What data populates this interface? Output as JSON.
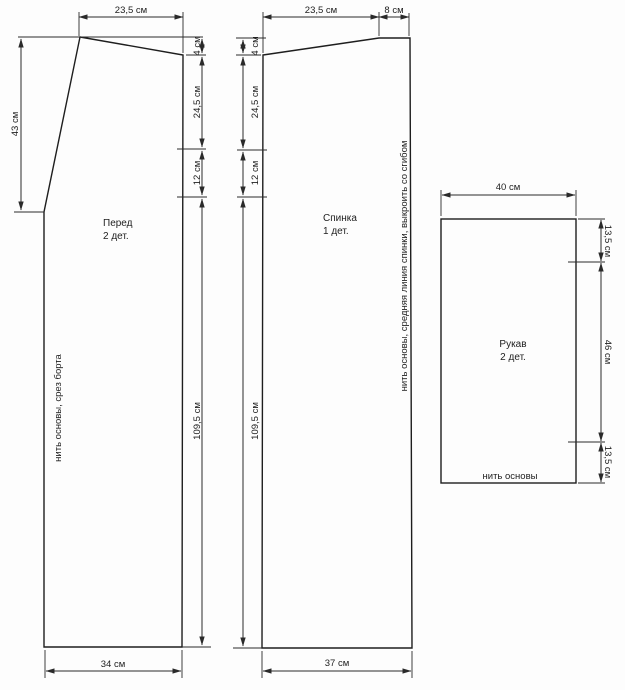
{
  "pieces": {
    "front": {
      "label": "Перед",
      "quantity": "2 дет.",
      "grain_line": "нить основы, срез борта",
      "dims": {
        "shoulder_width": "23,5 см",
        "front_edge_drop": "43 см",
        "shoulder_slope": "4 см",
        "armhole_depth": "24,5 см",
        "to_waist": "12 см",
        "side_length": "109,5 см",
        "hem_width": "34 см"
      }
    },
    "back": {
      "label": "Спинка",
      "quantity": "1 дет.",
      "grain_line": "нить основы, средняя линия спинки, выкроить со сгибом",
      "dims": {
        "shoulder_width": "23,5 см",
        "neck_width": "8 см",
        "shoulder_slope": "4 см",
        "armhole_depth": "24,5 см",
        "to_waist": "12 см",
        "side_length": "109,5 см",
        "hem_width": "37 см"
      }
    },
    "sleeve": {
      "label": "Рукав",
      "quantity": "2 дет.",
      "grain_line": "нить основы",
      "dims": {
        "width": "40 см",
        "top_offset": "13,5 см",
        "middle_length": "46 см",
        "bottom_offset": "13,5 см"
      }
    }
  },
  "colors": {
    "line": "#1e1e1e",
    "background": "#fdfdfd"
  }
}
